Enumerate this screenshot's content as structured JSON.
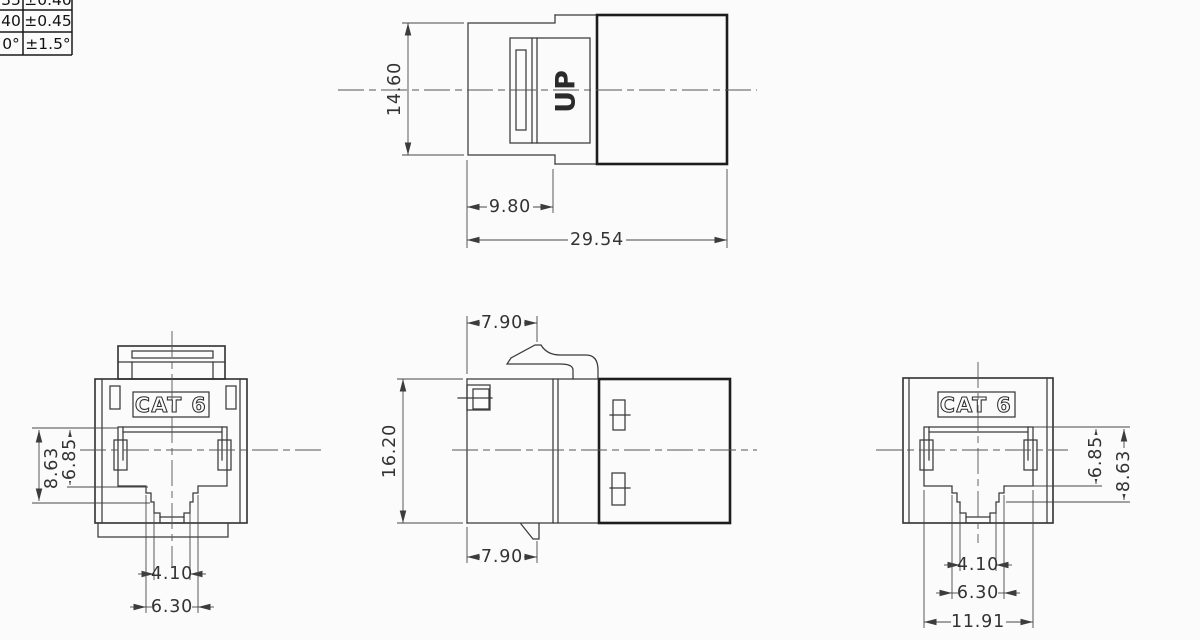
{
  "colors": {
    "line": "#3a3a3a",
    "background": "#fbfbfb"
  },
  "tolerance_table": {
    "rows": [
      {
        "limit": "35",
        "tolerance": "±0.40"
      },
      {
        "limit": "40",
        "tolerance": "±0.45"
      },
      {
        "limit": "0°",
        "tolerance": "±1.5°"
      }
    ]
  },
  "top_view": {
    "orientation_marking": "UP",
    "dim_height": "14.60",
    "dim_front_length": "9.80",
    "dim_total_length": "29.54"
  },
  "front_view": {
    "marking": "CAT 6",
    "dim_opening_height": "8.63",
    "dim_inner_height": "6.85",
    "dim_tab_width": "4.10",
    "dim_slot_width": "6.30"
  },
  "side_view": {
    "dim_front_top": "7.90",
    "dim_height": "16.20",
    "dim_front_bottom": "7.90"
  },
  "rear_view": {
    "marking": "CAT 6",
    "dim_inner_height": "6.85",
    "dim_opening_height": "8.63",
    "dim_tab_width": "4.10",
    "dim_slot_width": "6.30",
    "dim_opening_width": "11.91"
  }
}
